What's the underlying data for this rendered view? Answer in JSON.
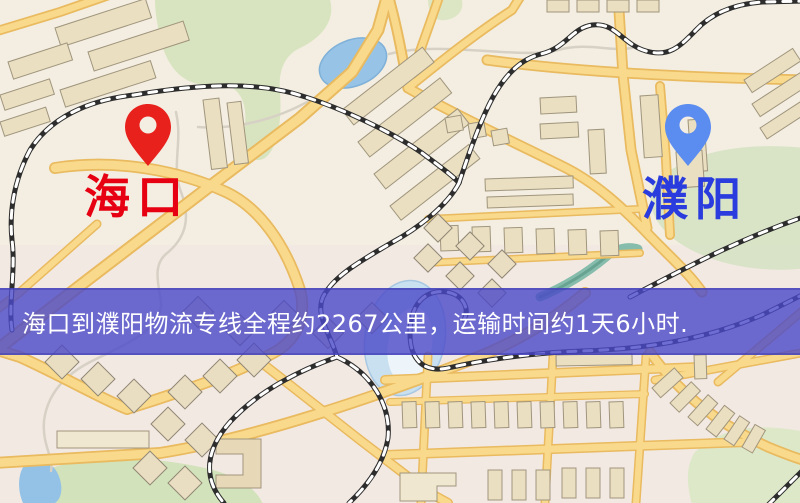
{
  "page": {
    "width": 800,
    "height": 503,
    "kind": "logistics-route-map"
  },
  "map": {
    "markers": [
      {
        "id": "origin",
        "label": "海口",
        "pin_color": "#e8211c",
        "label_color": "#e60012"
      },
      {
        "id": "destination",
        "label": "濮阳",
        "pin_color": "#5b8cf0",
        "label_color": "#2a3cdd"
      }
    ],
    "palette": {
      "base": "#f4efe4",
      "road_fill": "#f9da8c",
      "road_casing": "#e9ba5f",
      "building_fill": "#eadfc1",
      "building_stroke": "#a0957d",
      "green_area": "#d6e3bd",
      "water": "#96c3e6",
      "railway_dark": "#2d2d2d",
      "railway_dash": "#ffffff"
    }
  },
  "banner": {
    "text": "海口到濮阳物流专线全程约2267公里，运输时间约1天6小时.",
    "background": "rgba(74,73,200,0.8)",
    "text_color": "#ffffff"
  },
  "route": {
    "origin": "海口",
    "destination": "濮阳",
    "distance_km": "2267",
    "duration": "1天6小时"
  }
}
